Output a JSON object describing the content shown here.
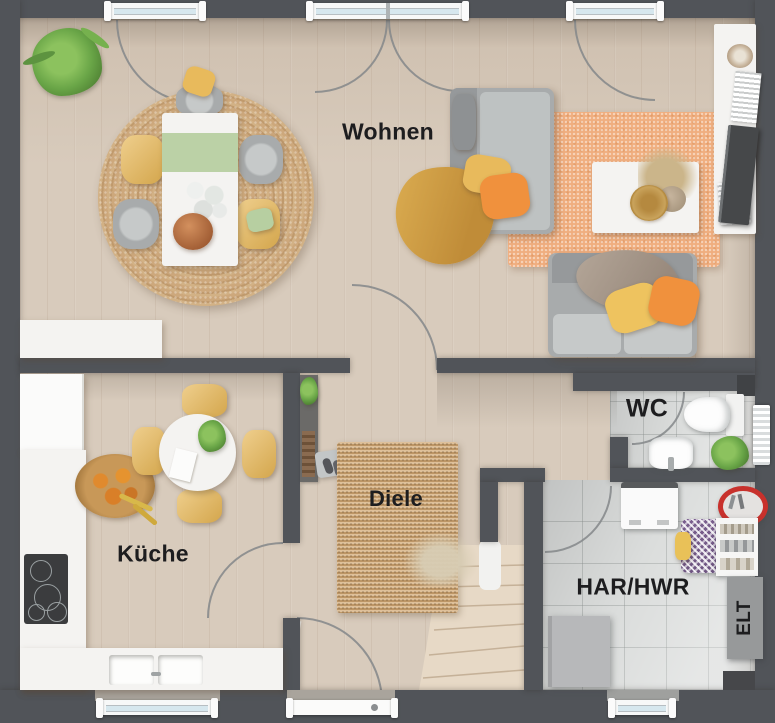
{
  "floorplan": {
    "rooms": {
      "wohnen": "Wohnen",
      "kueche": "Küche",
      "diele": "Diele",
      "wc": "WC",
      "har_hwr": "HAR/HWR",
      "elt": "ELT"
    },
    "colors": {
      "wall": "#515459",
      "outside": "#5d5e60",
      "wood_floor": "#d8cbbc",
      "tile_floor": "#dbdddc",
      "kitchen_white": "#f4f3f1",
      "sofa_gray": "#a8abac",
      "sofa_light": "#c6c9c9",
      "accent_yellow": "#e8ba5c",
      "accent_orange": "#f0913d",
      "accent_green": "#b7cfa1",
      "plant_green": "#69a547",
      "rug_jute": "#c9a475",
      "rug_peach": "#f0ae7f",
      "stair_wood": "#e7d9c6",
      "glass": "#d6e7ee",
      "red_accent": "#c8312c",
      "label": "#1d1d1f"
    }
  }
}
